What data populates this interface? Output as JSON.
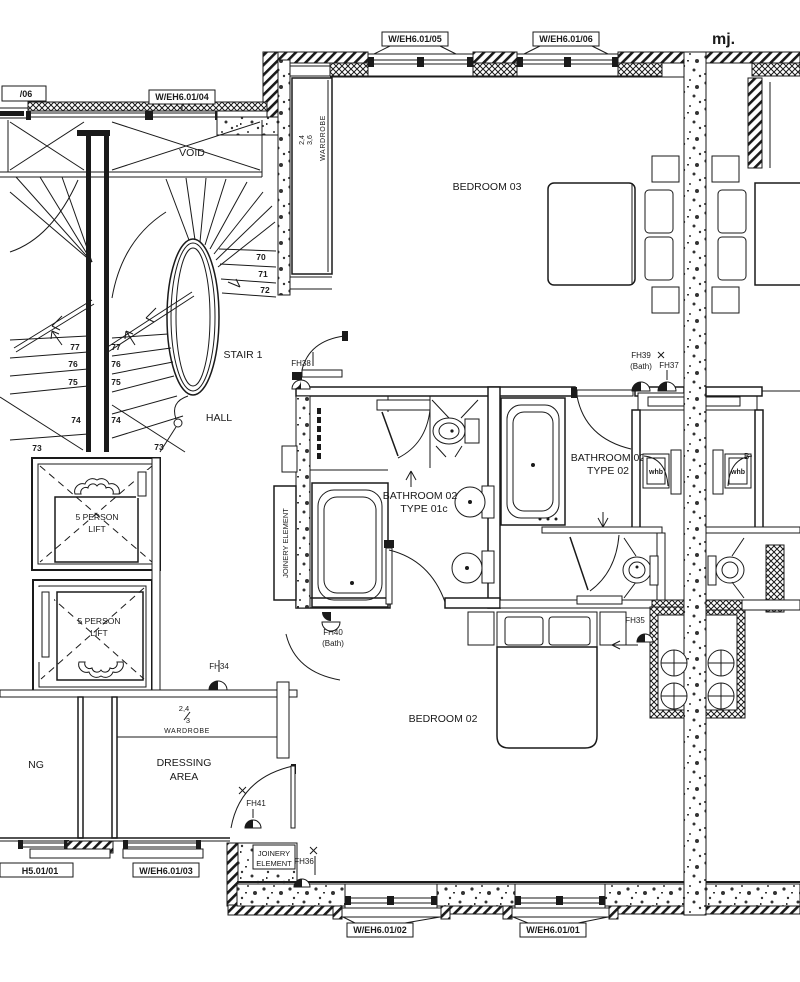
{
  "annotation": "mj.",
  "window_tags": {
    "w05": "W/EH6.01/05",
    "w06": "W/EH6.01/06",
    "w04": "W/EH6.01/04",
    "w06_cut": "/06",
    "w03": "W/EH6.01/03",
    "w01_cut": "H5.01/01",
    "w02": "W/EH6.01/02",
    "w01": "W/EH6.01/01"
  },
  "rooms": {
    "void": "VOID",
    "stair": "STAIR 1",
    "hall": "HALL",
    "bedroom03": "BEDROOM 03",
    "bedroom02": "BEDROOM 02",
    "bath01c_line1": "BATHROOM 02",
    "bath01c_line2": "TYPE 01c",
    "bath02_line1": "BATHROOM 02",
    "bath02_line2": "TYPE 02",
    "dressing_line1": "DRESSING",
    "dressing_line2": "AREA",
    "ng_partial": "NG",
    "b_partial": "B"
  },
  "fixtures": {
    "wardrobe_dressing": "WARDROBE",
    "wardrobe_bedroom03": "WARDROBE",
    "lift1_line1": "5 PERSON",
    "lift1_line2": "LIFT",
    "lift2_line1": "5 PERSON",
    "lift2_line2": "LIFT",
    "whb_left": "whb",
    "whb_right": "whb",
    "joinery_vertical": "JOINERY ELEMENT",
    "joinery_line1": "JOINERY",
    "joinery_line2": "ELEMENT"
  },
  "fire_tags": {
    "fh34": "FH34",
    "fh35": "FH35",
    "fh36": "FH36",
    "fh37": "FH37",
    "fh38": "FH38",
    "fh39": "FH39",
    "fh39_sub": "(Bath)",
    "fh40": "FH40",
    "fh40_sub": "(Bath)",
    "fh41": "FH41"
  },
  "stair_treads": {
    "n70": "70",
    "n71": "71",
    "n72": "72",
    "left": [
      "77",
      "76",
      "75",
      "74",
      "73"
    ],
    "mid": [
      "77",
      "76",
      "75",
      "74",
      "73"
    ]
  },
  "dimensions": {
    "dressing_num": "2,4",
    "dressing_den": "3",
    "wardrobe_a": "2,4",
    "wardrobe_b": "3,6"
  },
  "colors": {
    "ink": "#1a1a1a",
    "paper": "#ffffff"
  }
}
